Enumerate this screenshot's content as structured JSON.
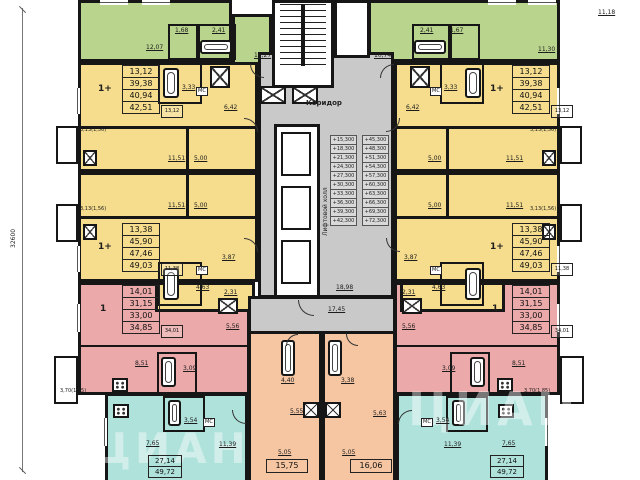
{
  "dimension_label": "32600",
  "watermark": {
    "text": "ЦИАН"
  },
  "core": {
    "corridor_label": "Коридор",
    "lift_hall_label": "Лифтовой холл",
    "lobby_area": "18,98",
    "corridor_area": "17,45",
    "elevations_left": [
      "+15,300",
      "+18,300",
      "+21,300",
      "+24,300",
      "+27,300",
      "+30,300",
      "+33,300",
      "+36,300",
      "+39,300",
      "+42,300"
    ],
    "elevations_right": [
      "+45,300",
      "+48,300",
      "+51,300",
      "+54,300",
      "+57,300",
      "+60,300",
      "+63,300",
      "+66,300",
      "+69,300",
      "+72,300"
    ]
  },
  "labels": [
    {
      "t": "12,07",
      "x": 146,
      "y": 44,
      "u": 1
    },
    {
      "t": "1,68",
      "x": 175,
      "y": 27,
      "u": 1
    },
    {
      "t": "2,41",
      "x": 212,
      "y": 27,
      "u": 1
    },
    {
      "t": "11,27",
      "x": 254,
      "y": 52,
      "u": 1
    },
    {
      "t": "10,74",
      "x": 374,
      "y": 52,
      "u": 1
    },
    {
      "t": "2,41",
      "x": 420,
      "y": 27,
      "u": 1
    },
    {
      "t": "1,67",
      "x": 450,
      "y": 27,
      "u": 1
    },
    {
      "t": "11,30",
      "x": 538,
      "y": 46,
      "u": 1
    },
    {
      "t": "11,18",
      "x": 598,
      "y": 9,
      "u": 1
    },
    {
      "t": "3,33",
      "x": 182,
      "y": 84,
      "u": 1
    },
    {
      "t": "6,42",
      "x": 224,
      "y": 104,
      "u": 1
    },
    {
      "t": "3,33",
      "x": 444,
      "y": 84,
      "u": 1
    },
    {
      "t": "6,42",
      "x": 406,
      "y": 104,
      "u": 1
    },
    {
      "t": "11,51",
      "x": 168,
      "y": 155,
      "u": 1
    },
    {
      "t": "5,00",
      "x": 194,
      "y": 155,
      "u": 1
    },
    {
      "t": "11,51",
      "x": 168,
      "y": 202,
      "u": 1
    },
    {
      "t": "5,00",
      "x": 194,
      "y": 202,
      "u": 1
    },
    {
      "t": "5,00",
      "x": 428,
      "y": 155,
      "u": 1
    },
    {
      "t": "11,51",
      "x": 506,
      "y": 155,
      "u": 1
    },
    {
      "t": "5,00",
      "x": 428,
      "y": 202,
      "u": 1
    },
    {
      "t": "11,51",
      "x": 506,
      "y": 202,
      "u": 1
    },
    {
      "t": "3,13(1,56)",
      "x": 80,
      "y": 127,
      "s": "xs"
    },
    {
      "t": "3,13(1,56)",
      "x": 80,
      "y": 206,
      "s": "xs"
    },
    {
      "t": "3,13(1,56)",
      "x": 530,
      "y": 127,
      "s": "xs"
    },
    {
      "t": "3,13(1,56)",
      "x": 530,
      "y": 206,
      "s": "xs"
    },
    {
      "t": "3,87",
      "x": 222,
      "y": 254,
      "u": 1
    },
    {
      "t": "4,63",
      "x": 196,
      "y": 284,
      "u": 1
    },
    {
      "t": "2,31",
      "x": 224,
      "y": 289,
      "u": 1
    },
    {
      "t": "3,87",
      "x": 404,
      "y": 254,
      "u": 1
    },
    {
      "t": "4,63",
      "x": 432,
      "y": 284,
      "u": 1
    },
    {
      "t": "2,31",
      "x": 402,
      "y": 289,
      "u": 1
    },
    {
      "t": "5,56",
      "x": 226,
      "y": 323,
      "u": 1
    },
    {
      "t": "8,51",
      "x": 135,
      "y": 360,
      "u": 1
    },
    {
      "t": "3,09",
      "x": 183,
      "y": 365,
      "u": 1
    },
    {
      "t": "5,56",
      "x": 402,
      "y": 323,
      "u": 1
    },
    {
      "t": "3,09",
      "x": 442,
      "y": 365,
      "u": 1
    },
    {
      "t": "8,51",
      "x": 512,
      "y": 360,
      "u": 1
    },
    {
      "t": "3,70(1,85)",
      "x": 60,
      "y": 388,
      "s": "xs"
    },
    {
      "t": "3,70(1,85)",
      "x": 524,
      "y": 388,
      "s": "xs"
    },
    {
      "t": "3,54",
      "x": 184,
      "y": 417,
      "u": 1
    },
    {
      "t": "7,65",
      "x": 146,
      "y": 440,
      "u": 1
    },
    {
      "t": "11,39",
      "x": 219,
      "y": 441,
      "u": 1
    },
    {
      "t": "3,54",
      "x": 436,
      "y": 417,
      "u": 1
    },
    {
      "t": "11,39",
      "x": 444,
      "y": 441,
      "u": 1
    },
    {
      "t": "7,65",
      "x": 502,
      "y": 440,
      "u": 1
    },
    {
      "t": "4,40",
      "x": 281,
      "y": 377,
      "u": 1
    },
    {
      "t": "5,55",
      "x": 290,
      "y": 408,
      "u": 1
    },
    {
      "t": "5,05",
      "x": 278,
      "y": 449,
      "u": 1
    },
    {
      "t": "3,38",
      "x": 341,
      "y": 377,
      "u": 1
    },
    {
      "t": "5,63",
      "x": 373,
      "y": 410,
      "u": 1
    },
    {
      "t": "5,05",
      "x": 342,
      "y": 449,
      "u": 1
    }
  ],
  "mc_labels": [
    {
      "t": "МС",
      "x": 196,
      "y": 87
    },
    {
      "t": "МС",
      "x": 430,
      "y": 87
    },
    {
      "t": "МС",
      "x": 196,
      "y": 266
    },
    {
      "t": "МС",
      "x": 430,
      "y": 266
    },
    {
      "t": "МС",
      "x": 203,
      "y": 418
    },
    {
      "t": "МС",
      "x": 421,
      "y": 418
    }
  ],
  "stamps": [
    {
      "x": 122,
      "y": 66,
      "w": 38,
      "rh": 13,
      "fs": 8,
      "type": "1+",
      "tx": 98,
      "ty": 86,
      "rows": [
        "13,12",
        "39,38",
        "40,94",
        "42,51"
      ],
      "extra": "13,12"
    },
    {
      "x": 122,
      "y": 224,
      "w": 38,
      "rh": 13,
      "fs": 8,
      "type": "1+",
      "tx": 98,
      "ty": 244,
      "rows": [
        "13,38",
        "45,90",
        "47,46",
        "49,03"
      ],
      "extra": "11,38"
    },
    {
      "x": 122,
      "y": 286,
      "w": 38,
      "rh": 13,
      "fs": 8,
      "type": "1",
      "tx": 100,
      "ty": 306,
      "rows": [
        "14,01",
        "31,15",
        "33,00",
        "34,85"
      ],
      "extra": "34,01"
    },
    {
      "x": 512,
      "y": 66,
      "w": 38,
      "rh": 13,
      "fs": 8,
      "type": "1+",
      "tx": 490,
      "ty": 86,
      "rows": [
        "13,12",
        "39,38",
        "40,94",
        "42,51"
      ],
      "extra": "13,12"
    },
    {
      "x": 512,
      "y": 224,
      "w": 38,
      "rh": 13,
      "fs": 8,
      "type": "1+",
      "tx": 490,
      "ty": 244,
      "rows": [
        "13,38",
        "45,90",
        "47,46",
        "49,03"
      ],
      "extra": "11,38"
    },
    {
      "x": 512,
      "y": 286,
      "w": 38,
      "rh": 13,
      "fs": 8,
      "type": "1",
      "tx": 492,
      "ty": 306,
      "rows": [
        "14,01",
        "31,15",
        "33,00",
        "34,85"
      ],
      "extra": "34,01"
    },
    {
      "x": 148,
      "y": 456,
      "w": 34,
      "rh": 12,
      "fs": 7,
      "rows": [
        "27,14",
        "49,72"
      ]
    },
    {
      "x": 490,
      "y": 456,
      "w": 34,
      "rh": 12,
      "fs": 7,
      "rows": [
        "27,14",
        "49,72"
      ]
    },
    {
      "x": 266,
      "y": 460,
      "w": 42,
      "rh": 14,
      "fs": 8,
      "rows": [
        "15,75"
      ]
    },
    {
      "x": 350,
      "y": 460,
      "w": 42,
      "rh": 14,
      "fs": 8,
      "rows": [
        "16,06"
      ]
    }
  ]
}
